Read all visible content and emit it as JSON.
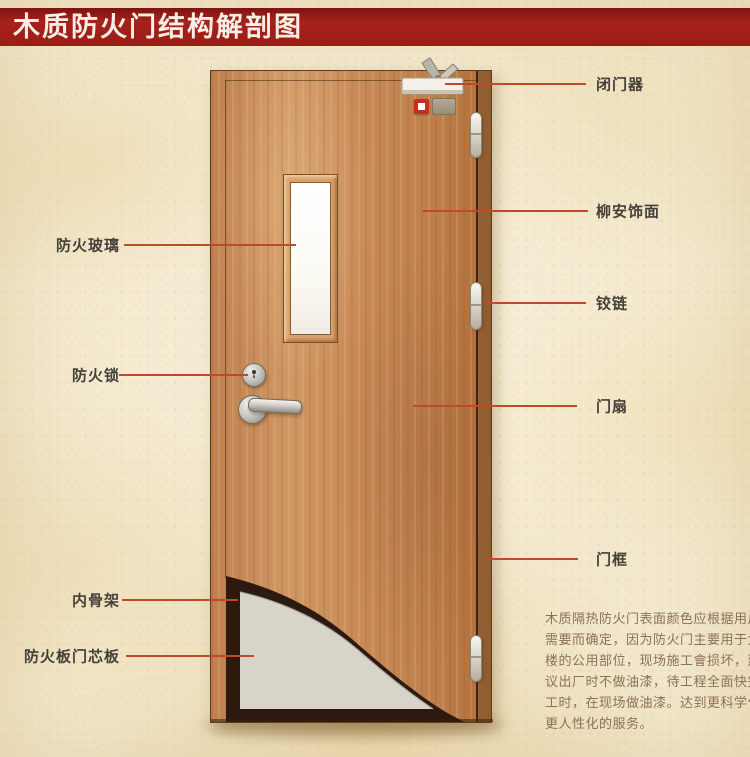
{
  "title": "木质防火门结构解剖图",
  "callouts": {
    "left": [
      {
        "id": "fire-glass",
        "label": "防火玻璃"
      },
      {
        "id": "fire-lock",
        "label": "防火锁"
      },
      {
        "id": "inner-skeleton",
        "label": "内骨架"
      },
      {
        "id": "fire-board-core",
        "label": "防火板门芯板"
      }
    ],
    "right": [
      {
        "id": "door-closer",
        "label": "闭门器"
      },
      {
        "id": "lauan-veneer",
        "label": "柳安饰面"
      },
      {
        "id": "hinge",
        "label": "铰链"
      },
      {
        "id": "door-leaf",
        "label": "门扇"
      },
      {
        "id": "door-frame",
        "label": "门框"
      }
    ]
  },
  "description": {
    "lines": [
      "木质隔热防火门表面颜色应根据用户",
      "需要而确定，因为防火门主要用于大",
      "楼的公用部位，现场施工會损坏，建",
      "议出厂时不做油漆，待工程全面快完",
      "工时，在现场做油漆。达到更科学化",
      "更人性化的服务。"
    ]
  },
  "colors": {
    "banner_red": "#9e1b16",
    "callout_line": "#c04a28",
    "label_text": "#44403a",
    "description_text": "#8d705a",
    "door_wood": "#c98b58",
    "door_frame_wood": "#a96f3e",
    "glass": "#fdfdf9",
    "core_board": "#d7d5c9",
    "inner_skeleton": "#2c1a10",
    "background": "#f2e8cc"
  }
}
